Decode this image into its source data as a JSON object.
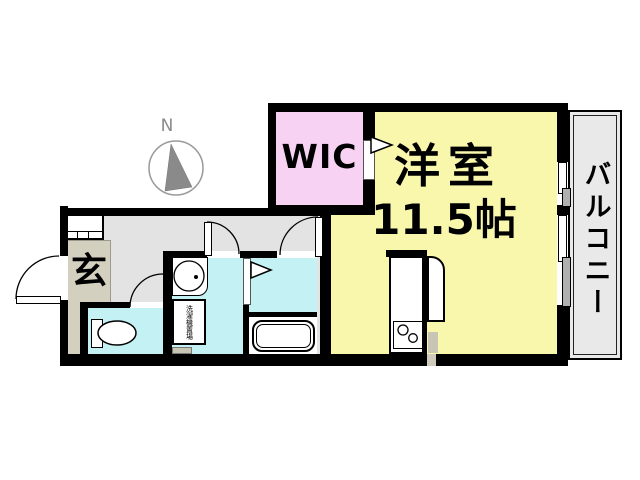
{
  "plan_title": "1R apartment floor plan",
  "compass": {
    "label": "N"
  },
  "rooms": {
    "wic": {
      "label": "WIC",
      "color": "#f8d2f3"
    },
    "main_room": {
      "label": "洋室",
      "size_label": "11.5帖",
      "color": "#f9f7ac"
    },
    "balcony": {
      "label": "バルコニー",
      "color": "#e9e9e9"
    },
    "entrance": {
      "label": "玄",
      "color": "#d4d0bf"
    },
    "hallway": {
      "color": "#e3e3e3"
    },
    "toilet": {
      "color": "#c4f1f3"
    },
    "washroom": {
      "color": "#c4f1f3",
      "washer_label": "洗濯機置場"
    },
    "bathroom": {
      "color": "#c4f1f3"
    }
  },
  "colors": {
    "walls": "#000000",
    "compass_needle": "#8a8a8a",
    "step_tan": "#c9c5b4"
  }
}
